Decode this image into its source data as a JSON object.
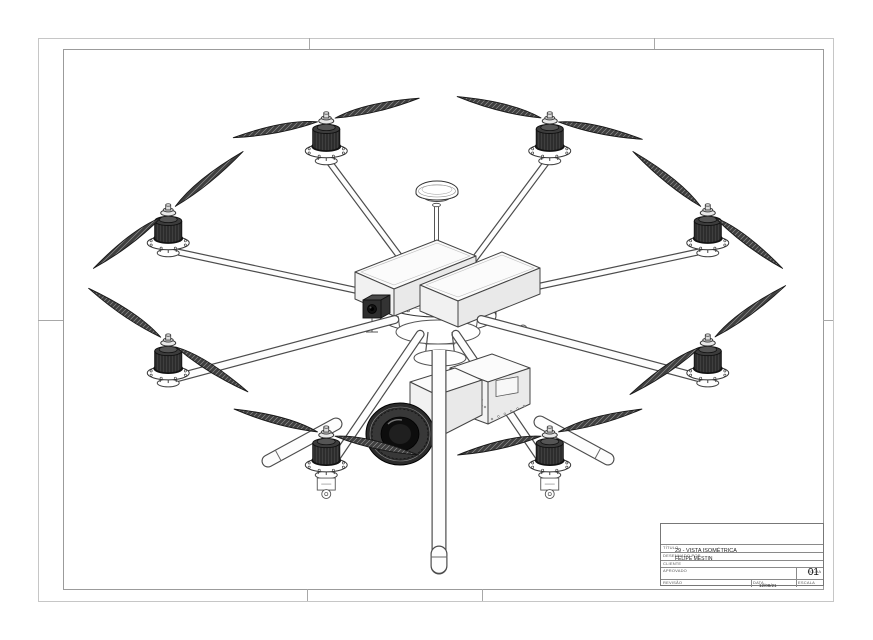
{
  "sheet": {
    "kind": "technical-drawing-sheet",
    "orientation": "landscape",
    "background": "#ffffff",
    "outer_border_color": "#c6c6c6",
    "inner_frame_color": "#9b9b9b"
  },
  "title_block": {
    "title_label": "TÍTULO",
    "title": "29 - VISTA ISOMÉTRICA",
    "author_label": "DESENHADO POR",
    "author": "FELIPE MESTIN",
    "client_label": "CLIENTE",
    "client": "",
    "approved_label": "APROVADO",
    "sheet_label": "FOLHA",
    "sheet_number": "01",
    "revision_label": "REVISÃO",
    "date_label": "DATA",
    "date": "12/08/21",
    "scale_label": "ESCALA"
  },
  "drawing": {
    "description": "Octocopter UAV with camera gimbal, GPS mast, twin battery packs and landing gear — isometric line drawing",
    "view": "VISTA ISOMÉTRICA",
    "motor_count": 8,
    "blades_per_rotor": 2,
    "components": [
      "two-blade propeller x8",
      "brushless motor x8",
      "motor mount flange x8",
      "carbon arm x8",
      "battery pack x2",
      "GPS antenna mast with dome",
      "center hub plates",
      "camera gimbal with lens",
      "equipment box",
      "landing skid x2",
      "center landing pole"
    ],
    "geometry": {
      "ring": {
        "cx": 438,
        "cy": 277,
        "rx": 292,
        "ry": 170
      },
      "hub": {
        "x": 438,
        "y": 308
      },
      "blade_len": 95,
      "rotors": [
        {
          "param_deg": 202.5,
          "blade_deg": -38,
          "layer": "rear"
        },
        {
          "param_deg": 247.5,
          "blade_deg": -12,
          "layer": "rear"
        },
        {
          "param_deg": 292.5,
          "blade_deg": 13,
          "layer": "rear"
        },
        {
          "param_deg": 337.5,
          "blade_deg": 38,
          "layer": "rear"
        },
        {
          "param_deg": 157.5,
          "blade_deg": 33,
          "layer": "front"
        },
        {
          "param_deg": 22.5,
          "blade_deg": -35,
          "layer": "front"
        },
        {
          "param_deg": 112.5,
          "blade_deg": 14,
          "layer": "front"
        },
        {
          "param_deg": 67.5,
          "blade_deg": -14,
          "layer": "front"
        }
      ]
    },
    "colors": {
      "line": "#333333",
      "dark_line": "#161616",
      "blade_fill": "#3f3f3f",
      "blade_hatch": "#8f8f8f",
      "motor_fill": "#2d2d2d",
      "face_white": "#fbfbfb",
      "lens_dark": "#101010"
    }
  }
}
